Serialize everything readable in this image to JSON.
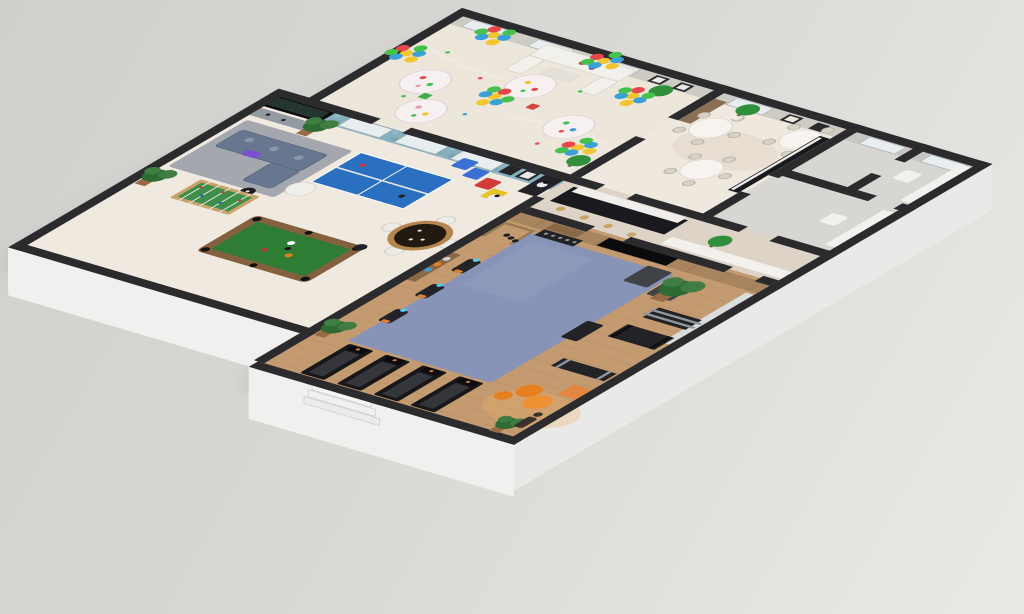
{
  "meta": {
    "kind": "isometric-3d-floor-plan-render",
    "setting": "clubhouse amenities floor cutaway render on plain studio background"
  },
  "palette": {
    "background_dark": "#d0cfcc",
    "background_light": "#eae9e6",
    "shadow": "#a8a6a3",
    "wall_top": "#2b2b2e",
    "wall_face_west": "#f4f4f2",
    "wall_face_south": "#f1f0ee",
    "wall_face_east": "#e9e9e7",
    "party_floor": "#ece6db",
    "dining_floor": "#eee8df",
    "rooms_floor": "#d8d6d3",
    "corridor_floor": "#ddd3c6",
    "games_floor": "#efe9e0",
    "gym_wood": "#c49b70",
    "gym_mat": "#8793b7",
    "gym_mat_worn": "#959fbe",
    "wallpaper_blue": "#86aebc",
    "wallpaper_dot_dark": "#6d98a8",
    "wallpaper_dot_light": "#9fc3cf",
    "north_wall_inner": "#cecbc5",
    "window": "#e8edef",
    "tv_screen": "#0b0b0e",
    "tv_glow": "#24362e",
    "wood_slat": "#a8855f",
    "wood_panel": "#8a6f52",
    "mirror": "#dce4e8",
    "pingpong_blue": "#2a6fc0",
    "pool_felt": "#2f7d35",
    "pool_rim": "#85603f",
    "foosball_green": "#3f8f4a",
    "foosball_frame": "#caa36a",
    "poker_rim": "#b5854f",
    "poker_top": "#221910",
    "sofa_blue": "#68778f",
    "sofa_cushion": "#8b98ac",
    "rug_navy": "#4a5670",
    "sofa_white": "#f2f0ea",
    "coffee_table": "#e5e0d7",
    "beanbag_white": "#f0eee8",
    "cube_blue": "#3a6fd4",
    "cube_red": "#d43a3a",
    "cube_yellow": "#e5c428",
    "table_cloth": "#f6f0f1",
    "dining_cloth": "#f7f4f0",
    "chair_beige": "#d8d1c6",
    "bar_dark": "#1a1a1e",
    "bar_top": "#f0eeea",
    "counter_white": "#f2f1ee",
    "stool_wood": "#caa36a",
    "treadmill": "#17171a",
    "treadmill_belt": "#35363c",
    "equip_dark": "#232327",
    "metal": "#92979d",
    "console_gray": "#939aa1",
    "orange_ball": "#e6801f",
    "orange_ball_light": "#ef9133",
    "orange_chair": "#e3863f",
    "accent_orange": "#e08030",
    "accent_purple": "#7a4fd0",
    "screen_blue": "#55c9e9",
    "warm_glow": "#f0b46a",
    "person": "#3a332b",
    "plant_green": "#2d6b33",
    "plant_light": "#3f7d43",
    "topiary": "#2f8f3a",
    "pot_white": "#efece6",
    "pot_brown": "#9a6a44",
    "balloon_yellow": "#f2c531",
    "balloon_blue": "#3aa0d8",
    "balloon_red": "#e8484d",
    "balloon_green": "#46c14e"
  },
  "scene": {
    "rooms": [
      {
        "id": "party-room",
        "label": "party room",
        "features": [
          "balloon-clusters",
          "round-party-tables",
          "white-sofa-set",
          "topiary-trees",
          "gift-boxes",
          "confetti"
        ]
      },
      {
        "id": "dining-room",
        "label": "dining room",
        "features": [
          "round-dining-tables",
          "dining-chairs",
          "wall-art",
          "kitchen-counter",
          "topiary"
        ]
      },
      {
        "id": "utility-rooms",
        "label": "utility rooms",
        "features": [
          "white-counters",
          "white-fixtures"
        ]
      },
      {
        "id": "hallway",
        "label": "hallway",
        "features": [
          "bar-counter",
          "bar-stools",
          "white-counter",
          "topiary-ball"
        ]
      },
      {
        "id": "games-room",
        "label": "games room",
        "features": [
          "floral-wallpaper",
          "wall-tv",
          "media-console",
          "blue-sofa",
          "navy-rug",
          "white-bean-bag",
          "ping-pong-table",
          "pool-table",
          "foosball-table",
          "poker-table",
          "bean-bag-cubes",
          "arcade-corner",
          "plants"
        ]
      },
      {
        "id": "gym",
        "label": "gym",
        "features": [
          "blue-exercise-mat",
          "treadmills",
          "exercise-bikes",
          "weight-racks",
          "dumbbell-rack",
          "wall-tv",
          "mirror",
          "orange-gym-balls",
          "plants",
          "person-silhouette",
          "wood-floor"
        ]
      }
    ],
    "counts": {
      "party_tables": 4,
      "balloon_clusters": 6,
      "dining_tables": 3,
      "treadmills": 4,
      "exercise_bikes": 3,
      "pool_tables": 1,
      "ping_pong_tables": 1
    }
  }
}
